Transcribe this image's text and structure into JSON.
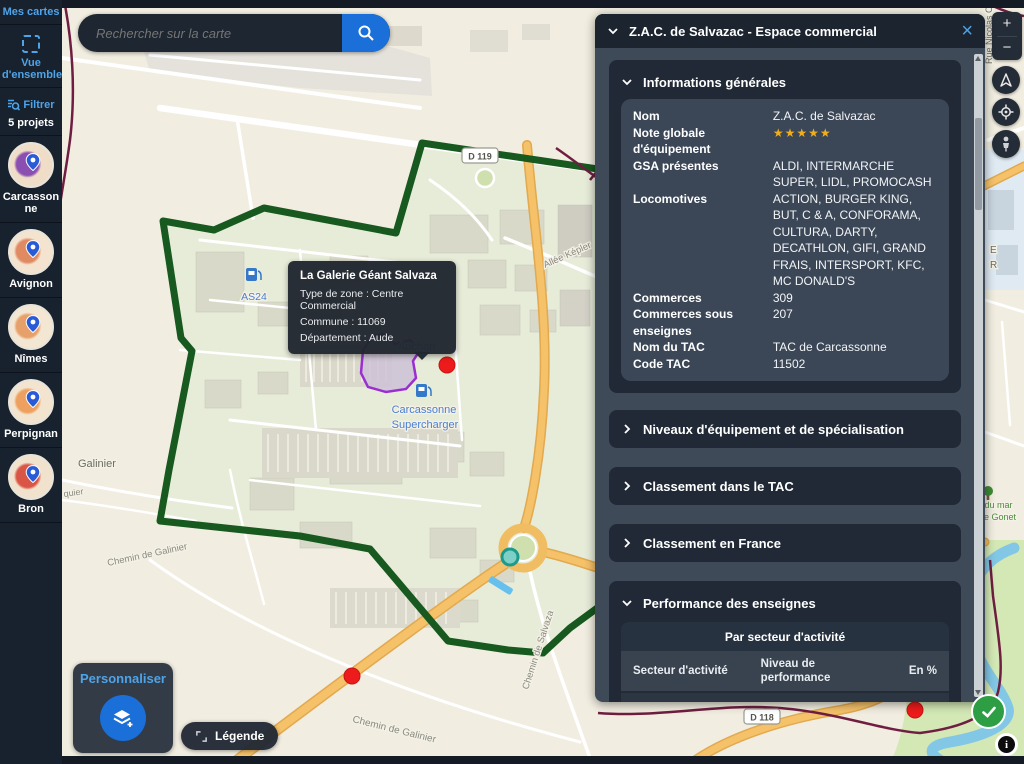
{
  "colors": {
    "accent_blue": "#4fa3e8",
    "button_blue": "#1a6fd8",
    "star_gold": "#f0ad1c",
    "check_green": "#2e9e44",
    "zone_green": "#17591f",
    "zone_purple": "#9a2fd0"
  },
  "sidebar": {
    "mes_cartes": "Mes cartes",
    "vue_densemble": "Vue d'ensemble",
    "filtrer": "Filtrer",
    "projects_count": "5 projets",
    "projects": [
      {
        "name": "Carcassonne",
        "blob": "#8a4fb0",
        "bg": "#f0ddc8"
      },
      {
        "name": "Avignon",
        "blob": "#e08a62",
        "bg": "#f3e3cf"
      },
      {
        "name": "Nîmes",
        "blob": "#e8a06a",
        "bg": "#f3e6d2"
      },
      {
        "name": "Perpignan",
        "blob": "#eda05f",
        "bg": "#f2e4cf"
      },
      {
        "name": "Bron",
        "blob": "#d95545",
        "bg": "#f1e2cd"
      }
    ]
  },
  "search": {
    "placeholder": "Rechercher sur la carte"
  },
  "panel": {
    "title": "Z.A.C. de Salvazac - Espace commercial",
    "info": {
      "title": "Informations générales",
      "rows": [
        {
          "label": "Nom",
          "value": "Z.A.C. de Salvazac"
        },
        {
          "label": "Note globale d'équipement",
          "value": "★★★★★",
          "stars": true
        },
        {
          "label": "GSA présentes",
          "value": "ALDI, INTERMARCHE SUPER, LIDL, PROMOCASH"
        },
        {
          "label": "Locomotives",
          "value": "ACTION, BURGER KING, BUT, C & A, CONFORAMA, CULTURA, DARTY, DECATHLON, GIFI, GRAND FRAIS, INTERSPORT, KFC, MC DONALD'S"
        },
        {
          "label": "Commerces",
          "value": "309"
        },
        {
          "label": "Commerces sous enseignes",
          "value": "207"
        },
        {
          "label": "Nom du TAC",
          "value": "TAC de Carcassonne"
        },
        {
          "label": "Code TAC",
          "value": "11502"
        }
      ]
    },
    "collapsed": [
      "Niveaux d'équipement et de spécialisation",
      "Classement dans le TAC",
      "Classement en France"
    ],
    "performance": {
      "title": "Performance des enseignes",
      "subtitle": "Par secteur d'activité",
      "headers": [
        "Secteur d'activité",
        "Niveau de performance",
        "En %"
      ],
      "rows": [
        {
          "sector": "Alimentaire",
          "marker_pct": 69,
          "value": "42 %"
        },
        {
          "sector": "Articles De Sports",
          "marker_pct": 49,
          "value": "6 %"
        }
      ]
    }
  },
  "tooltip": {
    "title": "La Galerie Géant Salvaza",
    "lines": [
      "Type de zone : Centre Commercial",
      "Commune : 11069",
      "Département : Aude"
    ]
  },
  "map": {
    "labels": [
      {
        "text": "Galinier",
        "x": 78,
        "y": 467,
        "rot": 0,
        "color": "#6d6d64",
        "size": 11,
        "anchor": "start"
      },
      {
        "text": "quier",
        "x": 64,
        "y": 497,
        "rot": -8,
        "color": "#8a8a80",
        "size": 9,
        "anchor": "start"
      },
      {
        "text": "Chemin de Galinier",
        "x": 108,
        "y": 566,
        "rot": -12,
        "color": "#8a8a80",
        "size": 9.5,
        "anchor": "start"
      },
      {
        "text": "Chemin de Galinier",
        "x": 352,
        "y": 722,
        "rot": 14,
        "color": "#8a8a80",
        "size": 10,
        "anchor": "start"
      },
      {
        "text": "Chemin de Salvaza",
        "x": 528,
        "y": 690,
        "rot": -72,
        "color": "#8a8a80",
        "size": 9.5,
        "anchor": "start"
      },
      {
        "text": "Allée Képler",
        "x": 545,
        "y": 268,
        "rot": -24,
        "color": "#8a8a80",
        "size": 9.5,
        "anchor": "start"
      },
      {
        "text": "Auchan",
        "x": 398,
        "y": 350,
        "rot": 0,
        "color": "#4a7fd0",
        "size": 11,
        "anchor": "start"
      },
      {
        "text": "Carcassonne",
        "x": 424,
        "y": 413,
        "rot": 0,
        "color": "#4a7fd0",
        "size": 11,
        "anchor": "middle"
      },
      {
        "text": "Supercharger",
        "x": 425,
        "y": 428,
        "rot": 0,
        "color": "#4a7fd0",
        "size": 11,
        "anchor": "middle"
      },
      {
        "text": "AS24",
        "x": 254,
        "y": 300,
        "rot": 0,
        "color": "#4a7fd0",
        "size": 10.5,
        "anchor": "middle"
      },
      {
        "text": "Rue Nicolas C",
        "x": 992,
        "y": 64,
        "rot": -90,
        "color": "#6d6d64",
        "size": 9,
        "anchor": "start"
      },
      {
        "text": "E",
        "x": 990,
        "y": 253,
        "rot": 0,
        "color": "#6d6d64",
        "size": 10,
        "anchor": "start"
      },
      {
        "text": "R",
        "x": 990,
        "y": 268,
        "rot": 0,
        "color": "#6d6d64",
        "size": 10,
        "anchor": "start"
      },
      {
        "text": "n du mar",
        "x": 977,
        "y": 508,
        "rot": 0,
        "color": "#4c8b3f",
        "size": 9,
        "anchor": "start"
      },
      {
        "text": "de Gonet",
        "x": 979,
        "y": 520,
        "rot": 0,
        "color": "#4c8b3f",
        "size": 9,
        "anchor": "start"
      }
    ],
    "shields": [
      {
        "text": "D 119",
        "x": 480,
        "y": 156
      },
      {
        "text": "D 118",
        "x": 762,
        "y": 717
      }
    ],
    "buttons": {
      "personnaliser": "Personnaliser",
      "legende": "Légende"
    }
  },
  "controls": {
    "zoom_in": "+",
    "zoom_out": "−",
    "info": "i"
  }
}
